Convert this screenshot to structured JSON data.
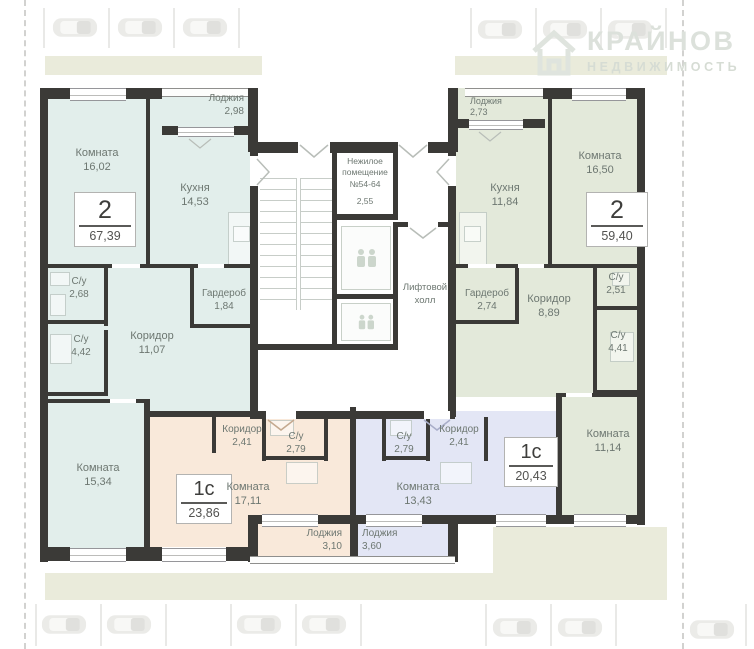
{
  "watermark": {
    "name": "КРАЙНОВ",
    "subtitle": "НЕДВИЖИМОСТЬ"
  },
  "core": {
    "nonresidential": {
      "line1": "Нежилое",
      "line2": "помещение",
      "line3": "№54-64",
      "area": "2,55"
    },
    "lift_hall": {
      "line1": "Лифтовой",
      "line2": "холл"
    }
  },
  "apartments": {
    "apt_a": {
      "type": "2",
      "area": "67,39",
      "rooms": {
        "loggia": {
          "name": "Лоджия",
          "area": "2,98"
        },
        "room1": {
          "name": "Комната",
          "area": "16,02"
        },
        "kitchen": {
          "name": "Кухня",
          "area": "14,53"
        },
        "bath1": {
          "name": "С/у",
          "area": "2,68"
        },
        "bath2": {
          "name": "С/у",
          "area": "4,42"
        },
        "hall": {
          "name": "Коридор",
          "area": "11,07"
        },
        "wardrobe": {
          "name": "Гардероб",
          "area": "1,84"
        },
        "room2": {
          "name": "Комната",
          "area": "15,34"
        }
      }
    },
    "apt_b": {
      "type": "2",
      "area": "59,40",
      "rooms": {
        "loggia": {
          "name": "Лоджия",
          "area": "2,73"
        },
        "kitchen": {
          "name": "Кухня",
          "area": "11,84"
        },
        "room1": {
          "name": "Комната",
          "area": "16,50"
        },
        "wardrobe": {
          "name": "Гардероб",
          "area": "2,74"
        },
        "hall": {
          "name": "Коридор",
          "area": "8,89"
        },
        "bath1": {
          "name": "С/у",
          "area": "2,51"
        },
        "bath2": {
          "name": "С/у",
          "area": "4,41"
        },
        "room2": {
          "name": "Комната",
          "area": "11,14"
        }
      }
    },
    "apt_c": {
      "type": "1с",
      "area": "23,86",
      "rooms": {
        "hall": {
          "name": "Коридор",
          "area": "2,41"
        },
        "bath": {
          "name": "С/у",
          "area": "2,79"
        },
        "room": {
          "name": "Комната",
          "area": "17,11"
        },
        "loggia": {
          "name": "Лоджия",
          "area": "3,10"
        }
      }
    },
    "apt_d": {
      "type": "1с",
      "area": "20,43",
      "rooms": {
        "bath": {
          "name": "С/у",
          "area": "2,79"
        },
        "hall": {
          "name": "Коридор",
          "area": "2,41"
        },
        "room": {
          "name": "Комната",
          "area": "13,43"
        },
        "loggia": {
          "name": "Лоджия",
          "area": "3,60"
        }
      }
    }
  },
  "colors": {
    "apt_a": "#e2eeeb",
    "apt_b": "#e3e9da",
    "apt_c": "#f9e9da",
    "apt_d": "#e3e6f5",
    "wall": "#3b3a37",
    "label_text": "#6d7771",
    "landscape": "#eaebdb",
    "watermark": "#dce1db"
  }
}
